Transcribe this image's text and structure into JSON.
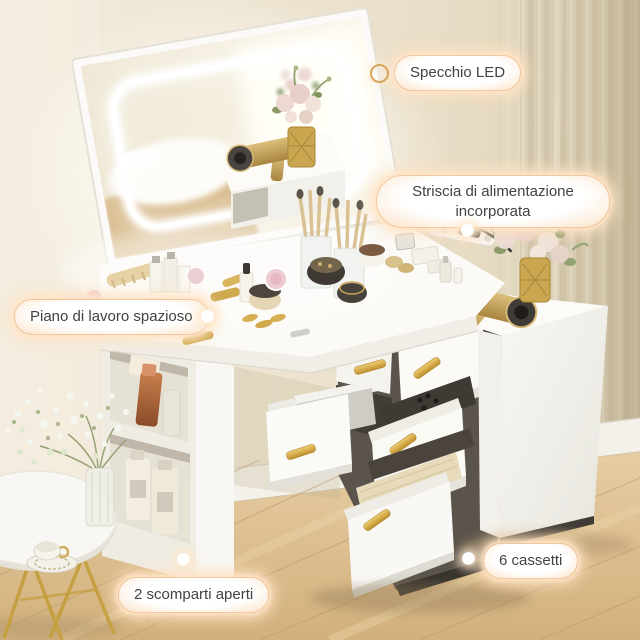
{
  "image": {
    "type": "product-photo",
    "subject": "corner makeup vanity with LED mirror, drawer cabinet and open shelves in a bedroom"
  },
  "callouts": {
    "mirror": {
      "label": "Specchio LED"
    },
    "power_strip": {
      "label": "Striscia di alimentazione incorporata"
    },
    "worktop": {
      "label": "Piano di lavoro spazioso"
    },
    "drawers": {
      "label": "6 cassetti"
    },
    "shelves": {
      "label": "2 scomparti aperti"
    }
  },
  "colors": {
    "pill_border": "#f2c79d",
    "pill_glow": "#ffe2c2",
    "pill_text": "#424242",
    "accent_gold": "#d8a645",
    "wall_beige": "#ece3d0",
    "curtain_beige": "#d8ccb2",
    "floor_wood": "#ddbf92",
    "furniture_white": "#f8f7f4"
  },
  "scene": {
    "objects": [
      "led-mirror",
      "vanity-desk",
      "six-drawer-cabinet",
      "open-shelf-compartments",
      "power-strip-with-plug",
      "gold-hair-dryer",
      "flower-vase",
      "cosmetics",
      "makeup-brushes",
      "jewelry-drawer",
      "side-table",
      "teacup",
      "babys-breath-bouquet",
      "curtain",
      "wood-floor"
    ]
  }
}
